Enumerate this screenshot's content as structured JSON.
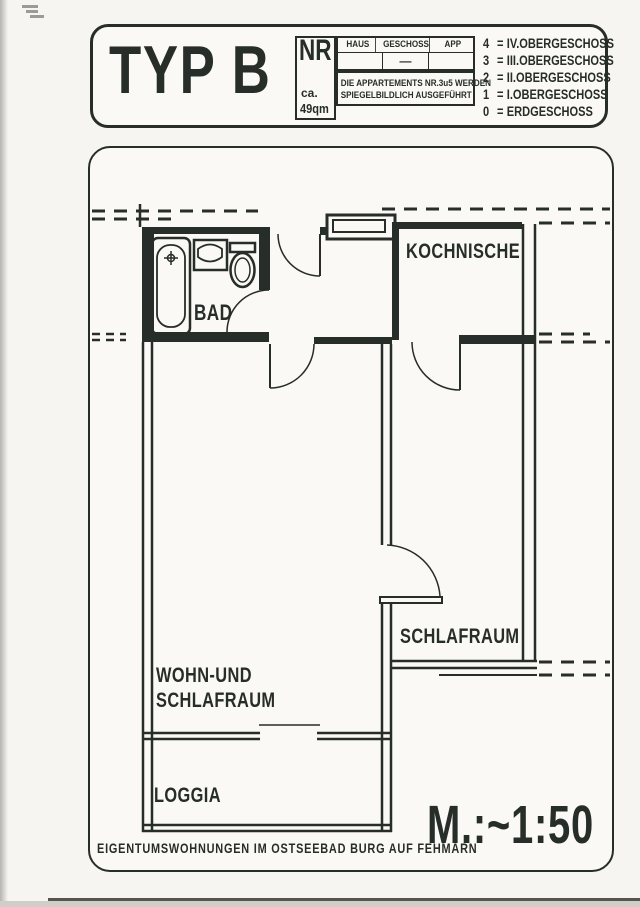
{
  "colors": {
    "ink": "#272d28",
    "paper": "#f6f5f1"
  },
  "header": {
    "type_label": "TYP B",
    "nr_label": "NR",
    "area_prefix": "ca.",
    "area_value": "49qm",
    "table": {
      "columns": [
        "HAUS",
        "GESCHOSS",
        "APP"
      ],
      "geschoss_value": "—"
    },
    "note_line1": "DIE APPARTEMENTS NR.3u5 WERDEN",
    "note_line2": "SPIEGELBILDLICH AUSGEFÜHRT",
    "eq": "=",
    "legend": [
      {
        "k": "4",
        "v": "IV.OBERGESCHOSS"
      },
      {
        "k": "3",
        "v": "III.OBERGESCHOSS"
      },
      {
        "k": "2",
        "v": "II.OBERGESCHOSS"
      },
      {
        "k": "1",
        "v": "I.OBERGESCHOSS"
      },
      {
        "k": "0",
        "v": "ERDGESCHOSS"
      }
    ]
  },
  "plan": {
    "rooms": {
      "bad": "BAD",
      "kochnische": "KOCHNISCHE",
      "schlafraum": "SCHLAFRAUM",
      "wohn_line1": "WOHN-UND",
      "wohn_line2": "SCHLAFRAUM",
      "loggia": "LOGGIA"
    },
    "footer": "EIGENTUMSWOHNUNGEN IM OSTSEEBAD BURG AUF FEHMARN",
    "scale_label": "M.:~1:50"
  }
}
